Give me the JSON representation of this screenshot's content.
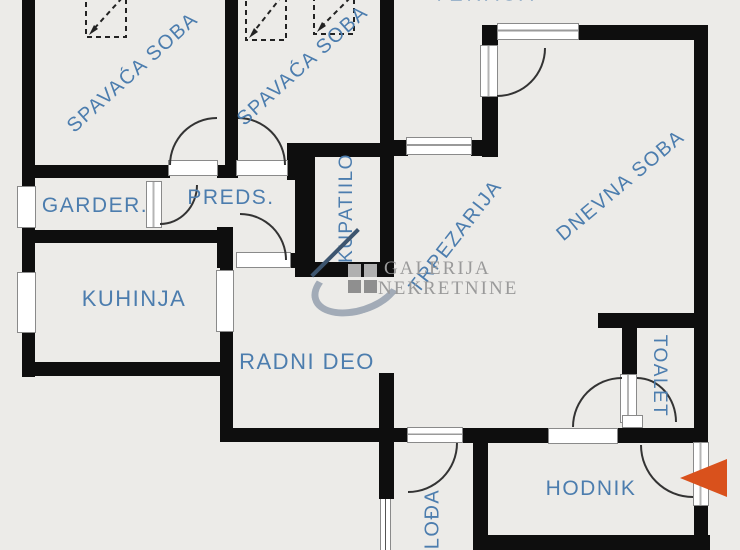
{
  "plan": {
    "labels": {
      "terasa": "TERASA",
      "spavaca_soba_1": "SPAVAĆA SOBA",
      "spavaca_soba_2": "SPAVAĆA SOBA",
      "garderoba": "GARDER.",
      "predsoblje": "PREDS.",
      "kupatilo": "KUPATIILO",
      "trpezarija": "TRPEZARIJA",
      "dnevna_soba": "DNEVNA SOBA",
      "kuhinja": "KUHINJA",
      "radni_deo": "RADNI DEO",
      "toalet": "TOALET",
      "hodnik": "HODNIK",
      "lodja": "LOĐA"
    },
    "watermark": {
      "line1": "GALERIJA",
      "line2": "NEKRETNINE"
    },
    "colors": {
      "label_blue": "#4c7dae",
      "wall": "#0e0e0e",
      "entrance_arrow": "#d9511c",
      "watermark_gray": "#9a9a9a",
      "background": "#ecebe8"
    }
  }
}
